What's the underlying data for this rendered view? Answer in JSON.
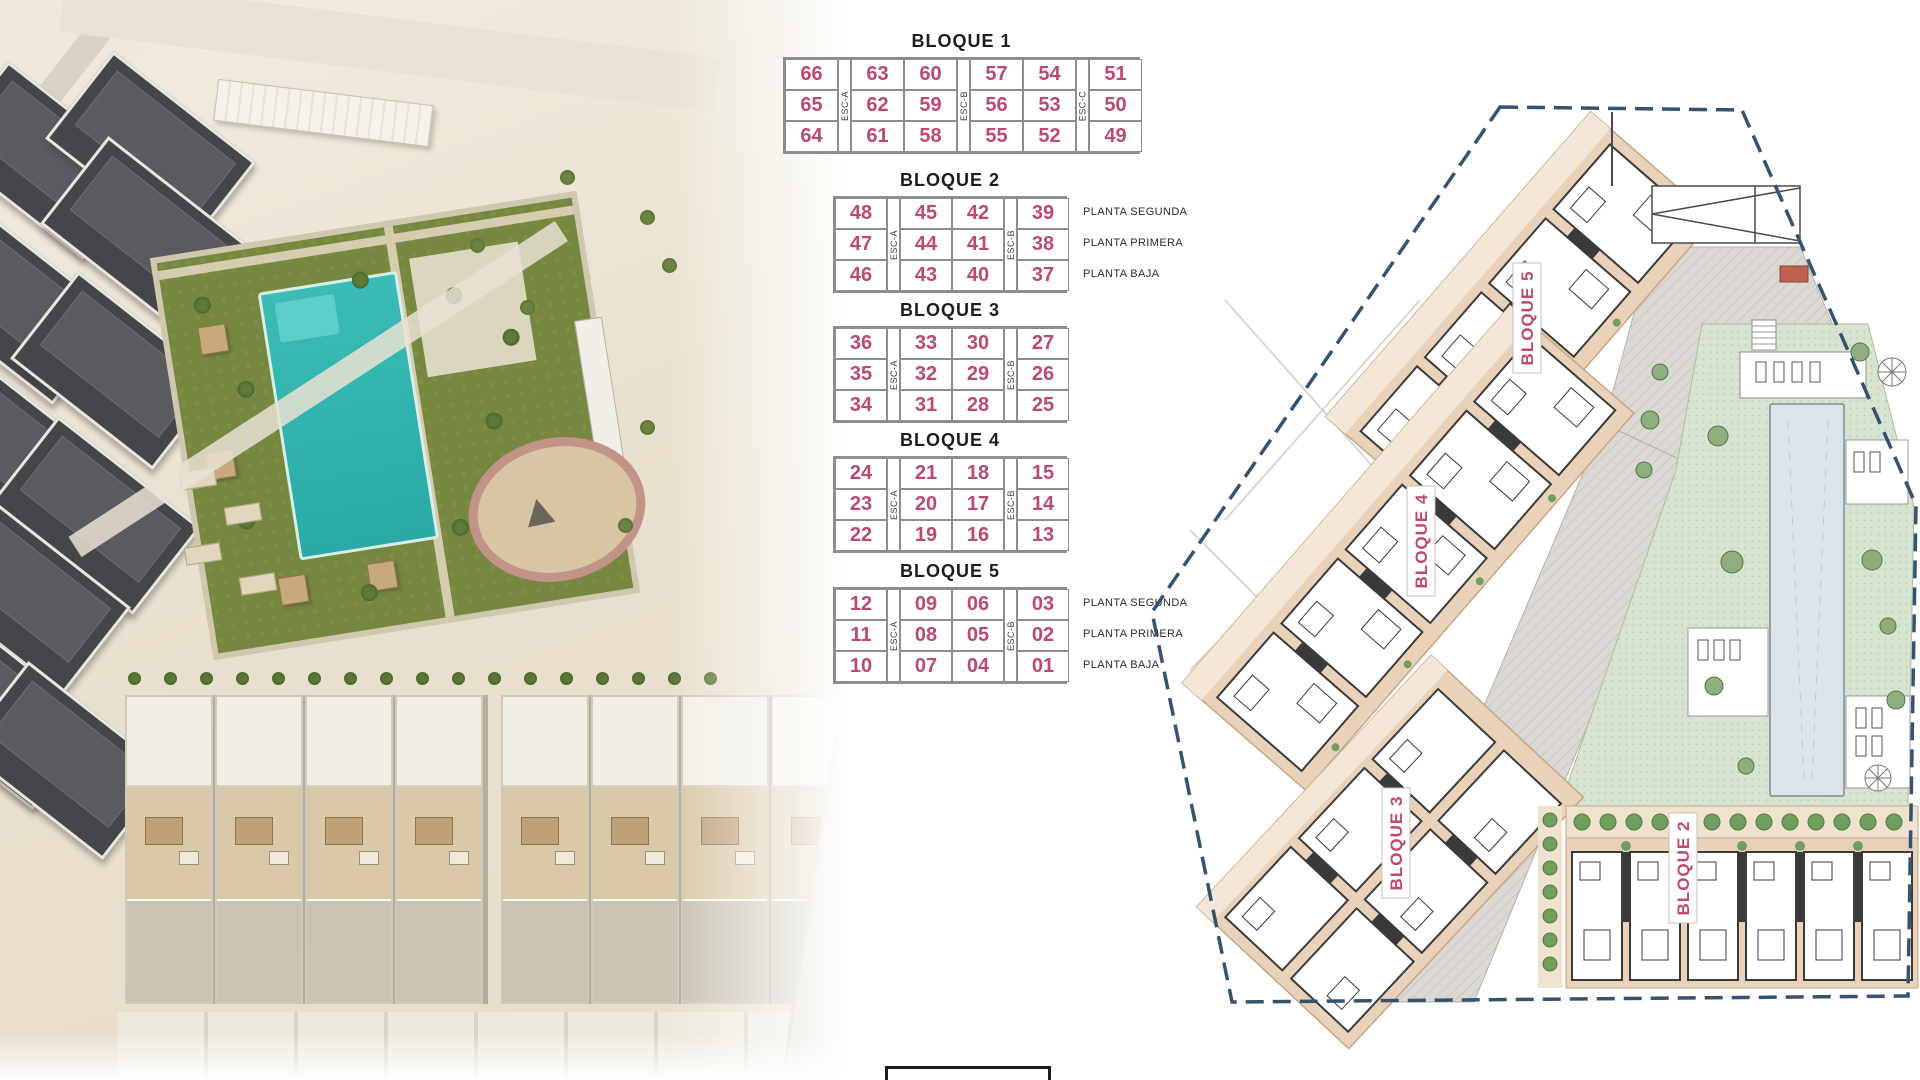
{
  "page": {
    "background": "#ffffff"
  },
  "colors": {
    "unit_number_pink": "#bc4a6c",
    "table_border_grey": "#8d8d8d",
    "table_title_black": "#1d1d1b",
    "plan_boundary_navy": "#35536f",
    "plan_block_tan": "#ead2ba",
    "plan_label_pink": "#c24867",
    "courtyard_green": "#d8e2d0",
    "pool_teal": "#35b7b1"
  },
  "tables": [
    {
      "title": "BLOQUE 1",
      "esc": [
        "ESC-A",
        "ESC-B",
        "ESC-C"
      ],
      "col_groups": [
        1,
        2,
        2,
        1
      ],
      "rows": [
        [
          "66",
          "63",
          "60",
          "57",
          "54",
          "51"
        ],
        [
          "65",
          "62",
          "59",
          "56",
          "53",
          "50"
        ],
        [
          "64",
          "61",
          "58",
          "55",
          "52",
          "49"
        ]
      ]
    },
    {
      "title": "BLOQUE 2",
      "esc": [
        "ESC-A",
        "ESC-B"
      ],
      "col_groups": [
        1,
        2,
        1
      ],
      "rows": [
        [
          "48",
          "45",
          "42",
          "39"
        ],
        [
          "47",
          "44",
          "41",
          "38"
        ],
        [
          "46",
          "43",
          "40",
          "37"
        ]
      ],
      "planta_labels": [
        "PLANTA SEGUNDA",
        "PLANTA PRIMERA",
        "PLANTA BAJA"
      ]
    },
    {
      "title": "BLOQUE 3",
      "esc": [
        "ESC-A",
        "ESC-B"
      ],
      "col_groups": [
        1,
        2,
        1
      ],
      "rows": [
        [
          "36",
          "33",
          "30",
          "27"
        ],
        [
          "35",
          "32",
          "29",
          "26"
        ],
        [
          "34",
          "31",
          "28",
          "25"
        ]
      ]
    },
    {
      "title": "BLOQUE 4",
      "esc": [
        "ESC-A",
        "ESC-B"
      ],
      "col_groups": [
        1,
        2,
        1
      ],
      "rows": [
        [
          "24",
          "21",
          "18",
          "15"
        ],
        [
          "23",
          "20",
          "17",
          "14"
        ],
        [
          "22",
          "19",
          "16",
          "13"
        ]
      ]
    },
    {
      "title": "BLOQUE 5",
      "esc": [
        "ESC-A",
        "ESC-B"
      ],
      "col_groups": [
        1,
        2,
        1
      ],
      "rows": [
        [
          "12",
          "09",
          "06",
          "03"
        ],
        [
          "11",
          "08",
          "05",
          "02"
        ],
        [
          "10",
          "07",
          "04",
          "01"
        ]
      ],
      "planta_labels": [
        "PLANTA SEGUNDA",
        "PLANTA PRIMERA",
        "PLANTA BAJA"
      ]
    }
  ],
  "plan": {
    "block_labels": [
      {
        "id": "bloque-5",
        "label": "BLOQUE 5"
      },
      {
        "id": "bloque-4",
        "label": "BLOQUE 4"
      },
      {
        "id": "bloque-3",
        "label": "BLOQUE 3"
      },
      {
        "id": "bloque-2",
        "label": "BLOQUE 2"
      }
    ]
  }
}
